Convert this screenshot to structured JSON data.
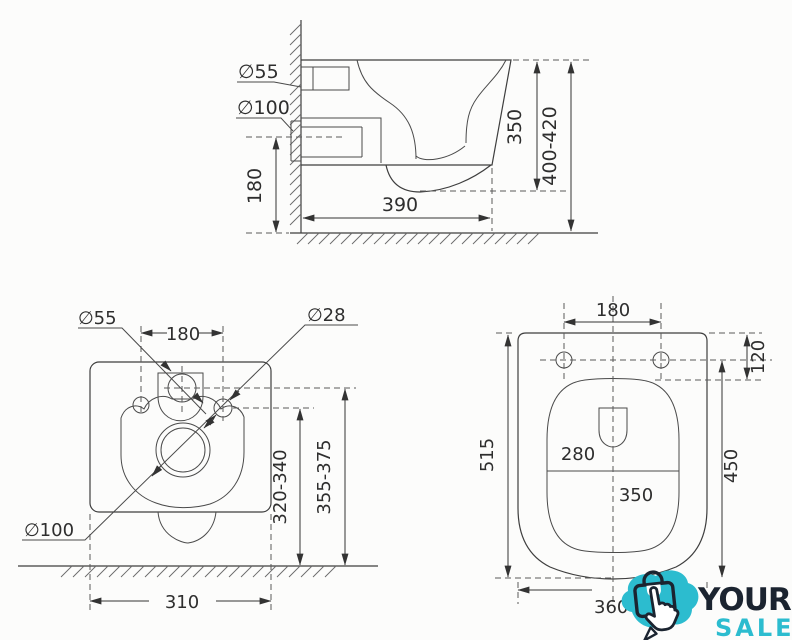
{
  "page": {
    "background": "#fcfcfb",
    "ink": "#3e3e3e",
    "text_color": "#2e2e2e"
  },
  "views": {
    "side": {
      "dims": {
        "inlet_diameter": "∅55",
        "outlet_diameter": "∅100",
        "outlet_height": "180",
        "depth": "390",
        "body_height": "350",
        "install_height": "400-420"
      }
    },
    "rear": {
      "dims": {
        "inlet_diameter": "∅55",
        "hole_diameter": "∅28",
        "outlet_diameter": "∅100",
        "hole_spacing": "180",
        "outlet_axis_height": "320-340",
        "inlet_axis_height": "355-375",
        "body_width": "310"
      }
    },
    "top": {
      "dims": {
        "hinge_spacing": "180",
        "hinge_offset": "120",
        "total_length": "515",
        "bowl_width": "280",
        "bowl_length": "350",
        "bowl_axis_length": "450",
        "seat_width": "360"
      }
    }
  },
  "logo": {
    "line1": "YOUR",
    "line2": "SALE",
    "teal": "#2cbccf",
    "navy": "#1b2430"
  }
}
